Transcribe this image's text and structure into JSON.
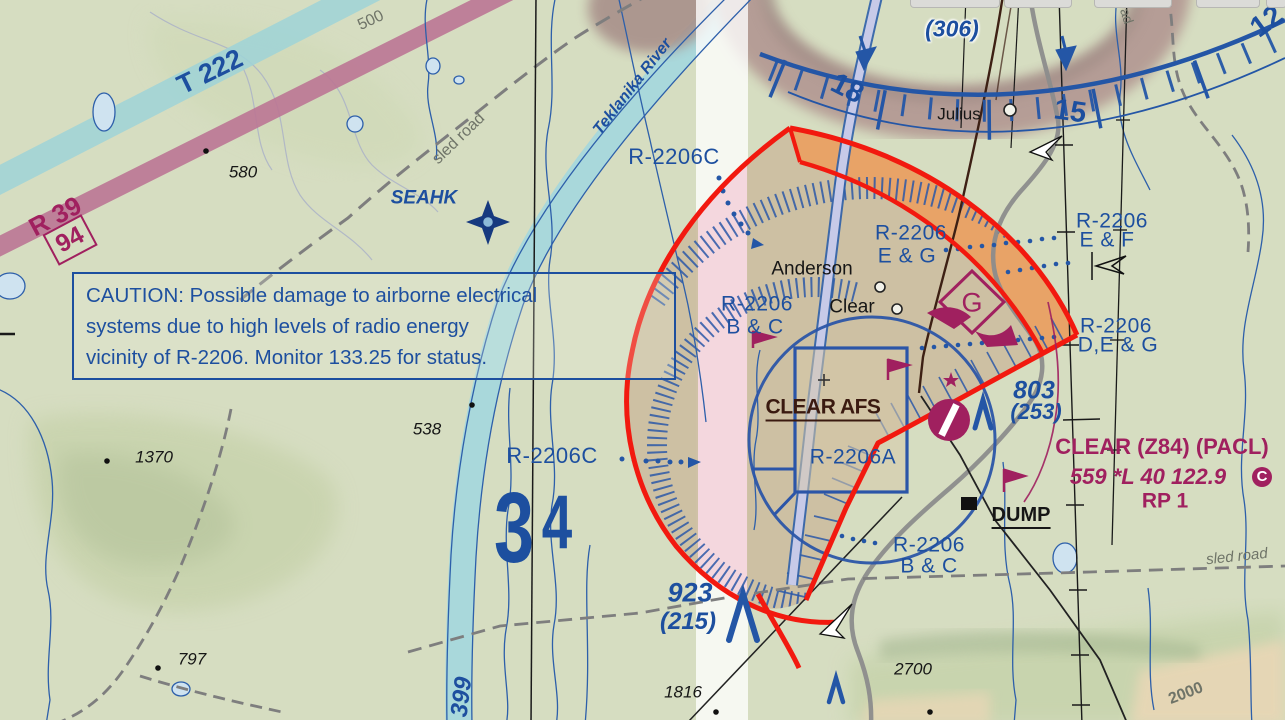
{
  "map": {
    "airways": {
      "t222": "T 222",
      "r39": "R 39",
      "r39_box": "94",
      "route399": "399"
    },
    "caution_box": {
      "line1": "CAUTION: Possible damage to airborne electrical",
      "line2": "systems due to high levels of radio energy",
      "line3": "vicinity of R-2206. Monitor 133.25 for status."
    },
    "restricted": {
      "r2206c_top": "R-2206C",
      "r2206c_mid": "R-2206C",
      "bc_left_1": "R-2206",
      "bc_left_2": "B & C",
      "eg_1": "R-2206",
      "eg_2": "E & G",
      "ef_1": "R-2206",
      "ef_2": "E & F",
      "deg_1": "R-2206",
      "deg_2": "D,E & G",
      "r2206a": "R-2206A",
      "bc_bottom_1": "R-2206",
      "bc_bottom_2": "B & C"
    },
    "places": {
      "anderson": "Anderson",
      "clear": "Clear",
      "julius": "Julius",
      "clear_afs": "CLEAR AFS",
      "dump": "DUMP",
      "seahk": "SEAHK"
    },
    "water": {
      "river": "Teklanika River"
    },
    "roads": {
      "sled_road_nw": "sled road",
      "sled_road_se": "sled road",
      "sled_road_ne_partial": "ad"
    },
    "elevations": {
      "spot_580": "580",
      "spot_538": "538",
      "spot_1370": "1370",
      "spot_797": "797",
      "spot_1816": "1816",
      "spot_2700": "2700",
      "contour_500": "500",
      "contour_2000": "2000",
      "mef_big": "3",
      "mef_small": "4"
    },
    "obstacles": {
      "o306_top": "763",
      "o306": "(306)",
      "o803": "803",
      "o253": "(253)",
      "o923": "923",
      "o215": "(215)"
    },
    "airport": {
      "name": "CLEAR (Z84) (PACL)",
      "info": "559 *L 40 122.9",
      "info_c": "C",
      "rp": "RP 1"
    },
    "compass": {
      "n18": "18",
      "n15": "15",
      "n12": "12"
    },
    "glider_symbol": "G"
  }
}
